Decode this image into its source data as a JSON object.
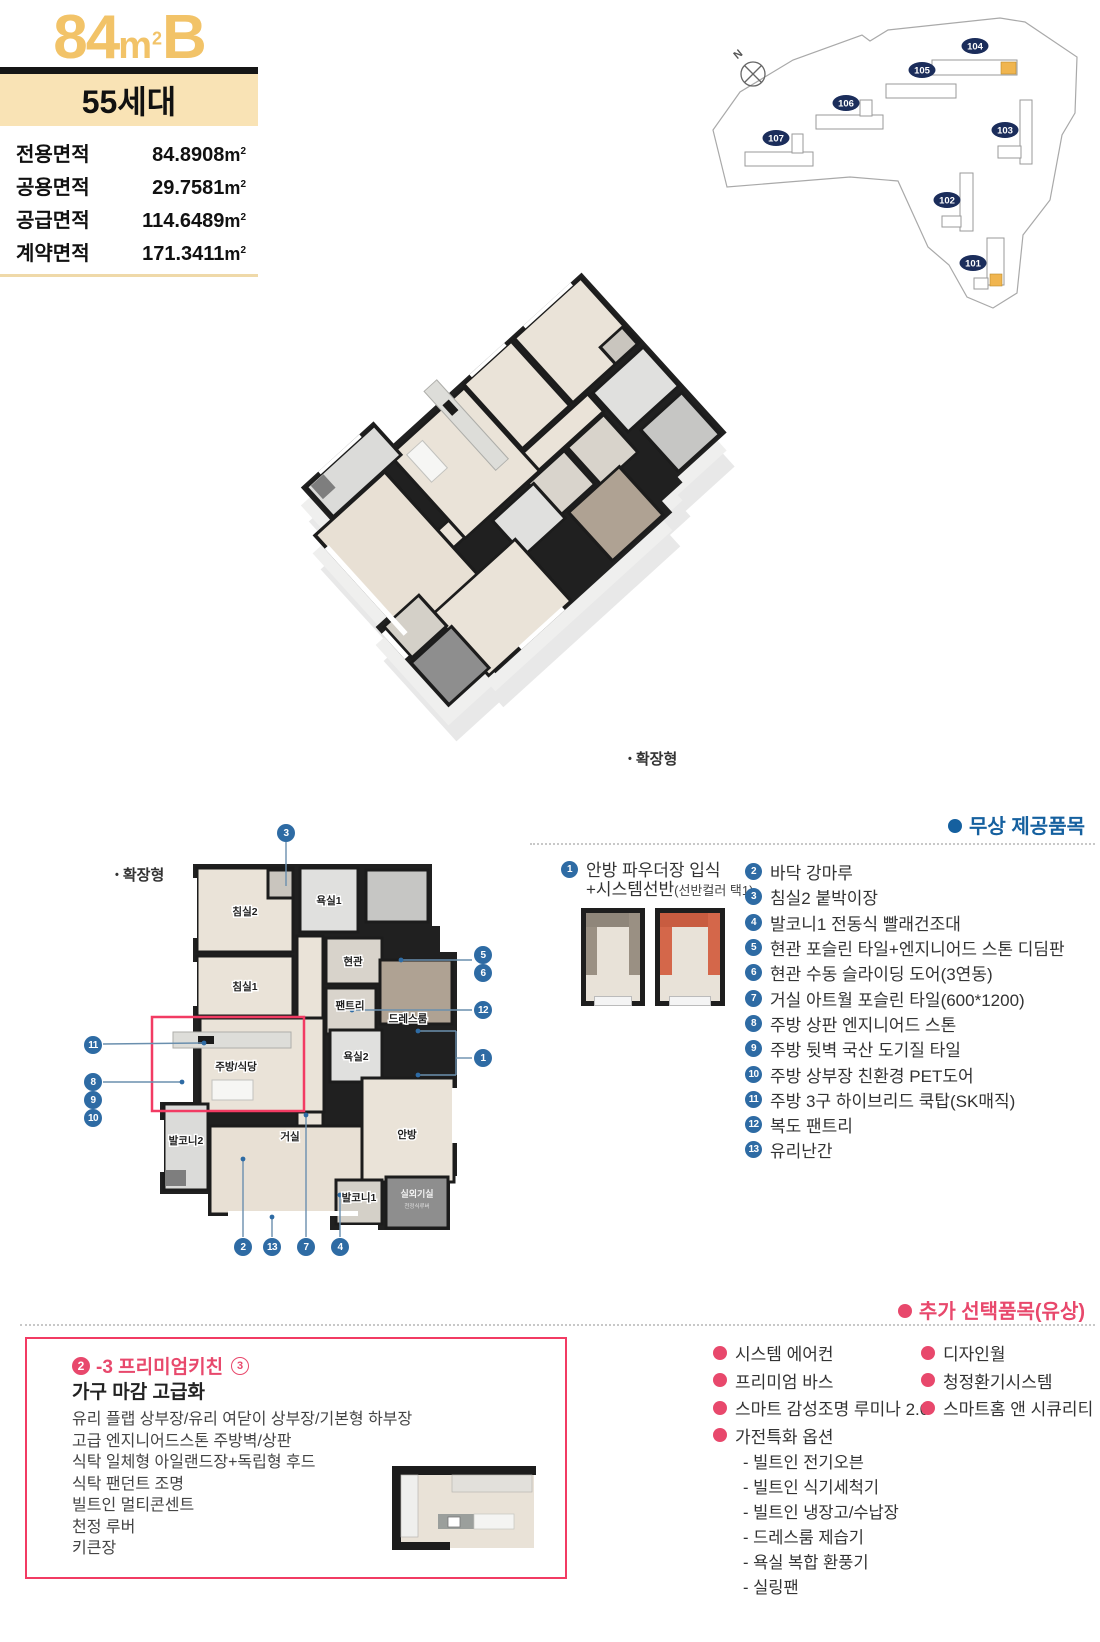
{
  "colors": {
    "accent_gold": "#F2C368",
    "band_bg": "#F9E3B5",
    "blue": "#15609F",
    "callout_blue": "#2E6BA4",
    "navy": "#1B2D5B",
    "pink": "#E8486C",
    "red_box": "#F23B63",
    "highlight_unit": "#F0B54F"
  },
  "unit": {
    "number": "84",
    "unit_m": "m",
    "unit_sup": "2",
    "type_letter": "B",
    "households": "55세대"
  },
  "areas": {
    "unit_m": "m",
    "unit_sup": "2",
    "rows": [
      {
        "label": "전용면적",
        "value": "84.8908"
      },
      {
        "label": "공용면적",
        "value": "29.7581"
      },
      {
        "label": "공급면적",
        "value": "114.6489"
      },
      {
        "label": "계약면적",
        "value": "171.3411"
      }
    ]
  },
  "site_map": {
    "compass": "N",
    "buildings": [
      {
        "id": "104"
      },
      {
        "id": "105"
      },
      {
        "id": "106"
      },
      {
        "id": "107"
      },
      {
        "id": "103"
      },
      {
        "id": "102"
      },
      {
        "id": "101"
      }
    ]
  },
  "plan3d": {
    "label": "확장형"
  },
  "plan2d": {
    "label": "확장형",
    "rooms": {
      "bedroom2": "침실2",
      "bath1": "욕실1",
      "entrance": "현관",
      "bedroom1": "침실1",
      "pantry": "팬트리",
      "dressroom": "드레스룸",
      "bath2": "욕실2",
      "kitchen": "주방/식당",
      "balcony2": "발코니2",
      "living": "거실",
      "master": "안방",
      "balcony1": "발코니1",
      "outdoor_unit": "실외기실",
      "outdoor_unit_sub": "천정식루버"
    },
    "callouts": [
      "1",
      "2",
      "3",
      "4",
      "5",
      "6",
      "7",
      "8",
      "9",
      "10",
      "11",
      "12",
      "13"
    ]
  },
  "free_items": {
    "header": "무상 제공품목",
    "item1": {
      "num": "1",
      "line1": "안방 파우더장 입식",
      "line2": "+시스템선반",
      "line2_note": "(선반컬러 택1)"
    },
    "list": [
      {
        "num": "2",
        "text": "바닥 강마루"
      },
      {
        "num": "3",
        "text": "침실2 붙박이장"
      },
      {
        "num": "4",
        "text": "발코니1 전동식 빨래건조대"
      },
      {
        "num": "5",
        "text": "현관 포슬린 타일+엔지니어드 스톤 디딤판"
      },
      {
        "num": "6",
        "text": "현관 수동 슬라이딩 도어(3연동)"
      },
      {
        "num": "7",
        "text": "거실 아트월 포슬린 타일(600*1200)"
      },
      {
        "num": "8",
        "text": "주방 상판 엔지니어드 스톤"
      },
      {
        "num": "9",
        "text": "주방 뒷벽 국산 도기질 타일"
      },
      {
        "num": "10",
        "text": "주방 상부장 친환경 PET도어"
      },
      {
        "num": "11",
        "text": "주방 3구 하이브리드 쿡탑(SK매직)"
      },
      {
        "num": "12",
        "text": "복도 팬트리"
      },
      {
        "num": "13",
        "text": "유리난간"
      }
    ]
  },
  "paid_items": {
    "header": "추가 선택품목(유상)",
    "premium_box": {
      "badge_num": "2",
      "title": "-3 프리미엄키친",
      "title_circle": "3",
      "subtitle": "가구 마감 고급화",
      "lines": [
        "유리 플랩 상부장/유리 여닫이 상부장/기본형 하부장",
        "고급 엔지니어드스톤 주방벽/상판",
        "식탁 일체형 아일랜드장+독립형 후드",
        "식탁 팬던트 조명",
        "빌트인 멀티콘센트",
        "천정 루버",
        "키큰장"
      ]
    },
    "col1": [
      "시스템 에어컨",
      "프리미엄 바스",
      "스마트 감성조명 루미나 2.0",
      "가전특화 옵션"
    ],
    "col1_subs": [
      "- 빌트인 전기오븐",
      "- 빌트인 식기세척기",
      "- 빌트인 냉장고/수납장",
      "- 드레스룸 제습기",
      "- 욕실 복합 환풍기",
      "- 실링팬"
    ],
    "col2": [
      "디자인월",
      "청정환기시스템",
      "스마트홈 앤 시큐리티"
    ]
  }
}
